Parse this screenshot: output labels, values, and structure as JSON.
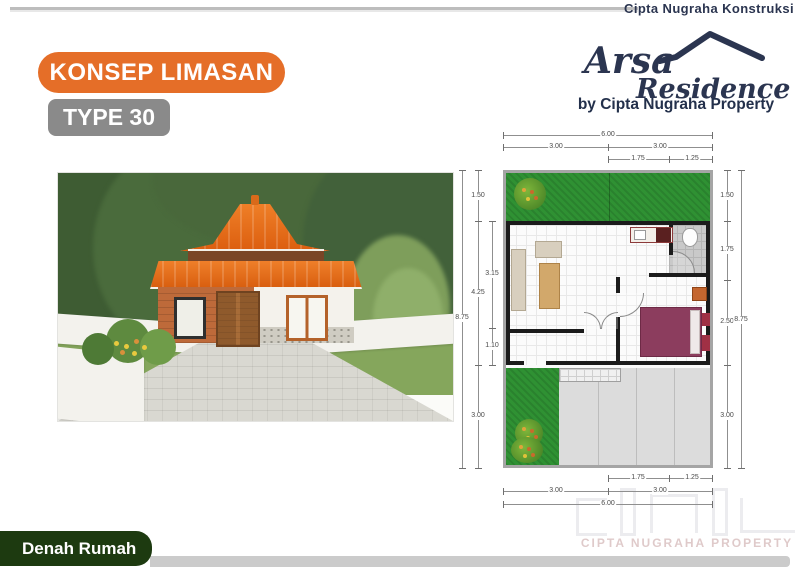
{
  "header": {
    "company_top": "Cipta Nugraha Konstruksi",
    "title_badge": "KONSEP LIMASAN",
    "type_badge": "TYPE 30",
    "logo_line1": "Arsa",
    "logo_line2": "Residence",
    "logo_byline": "by Cipta Nugraha Property"
  },
  "floorplan": {
    "dims": {
      "top_overall": "6.00",
      "top_left_half": "3.00",
      "top_right_half": "3.00",
      "top_sub_a": "1.75",
      "top_sub_b": "1.25",
      "bottom_sub_a": "1.75",
      "bottom_sub_b": "1.25",
      "bottom_left_half": "3.00",
      "bottom_right_half": "3.00",
      "bottom_overall": "6.00",
      "left_overall": "8.75",
      "left_seg_top": "1.50",
      "left_seg_mid": "4.25",
      "left_seg_bottom": "3.00",
      "left_sub_a": "3.15",
      "left_sub_b": "1.10",
      "right_seg_1": "1.50",
      "right_seg_2": "1.75",
      "right_seg_3": "2.50",
      "right_seg_4": "3.00",
      "right_overall": "8.75"
    }
  },
  "watermark": {
    "text": "CIPTA NUGRAHA PROPERTY"
  },
  "footer": {
    "caption": "Denah Rumah"
  },
  "colors": {
    "accent_orange": "#E56E28",
    "type_badge_gray": "#8A8A8A",
    "brand_navy": "#2B3550",
    "footer_green": "#1D3A10",
    "plan_grass_green": "#2F9133",
    "roof_orange": "#E8681C",
    "bed_maroon": "#8C3D5E"
  }
}
